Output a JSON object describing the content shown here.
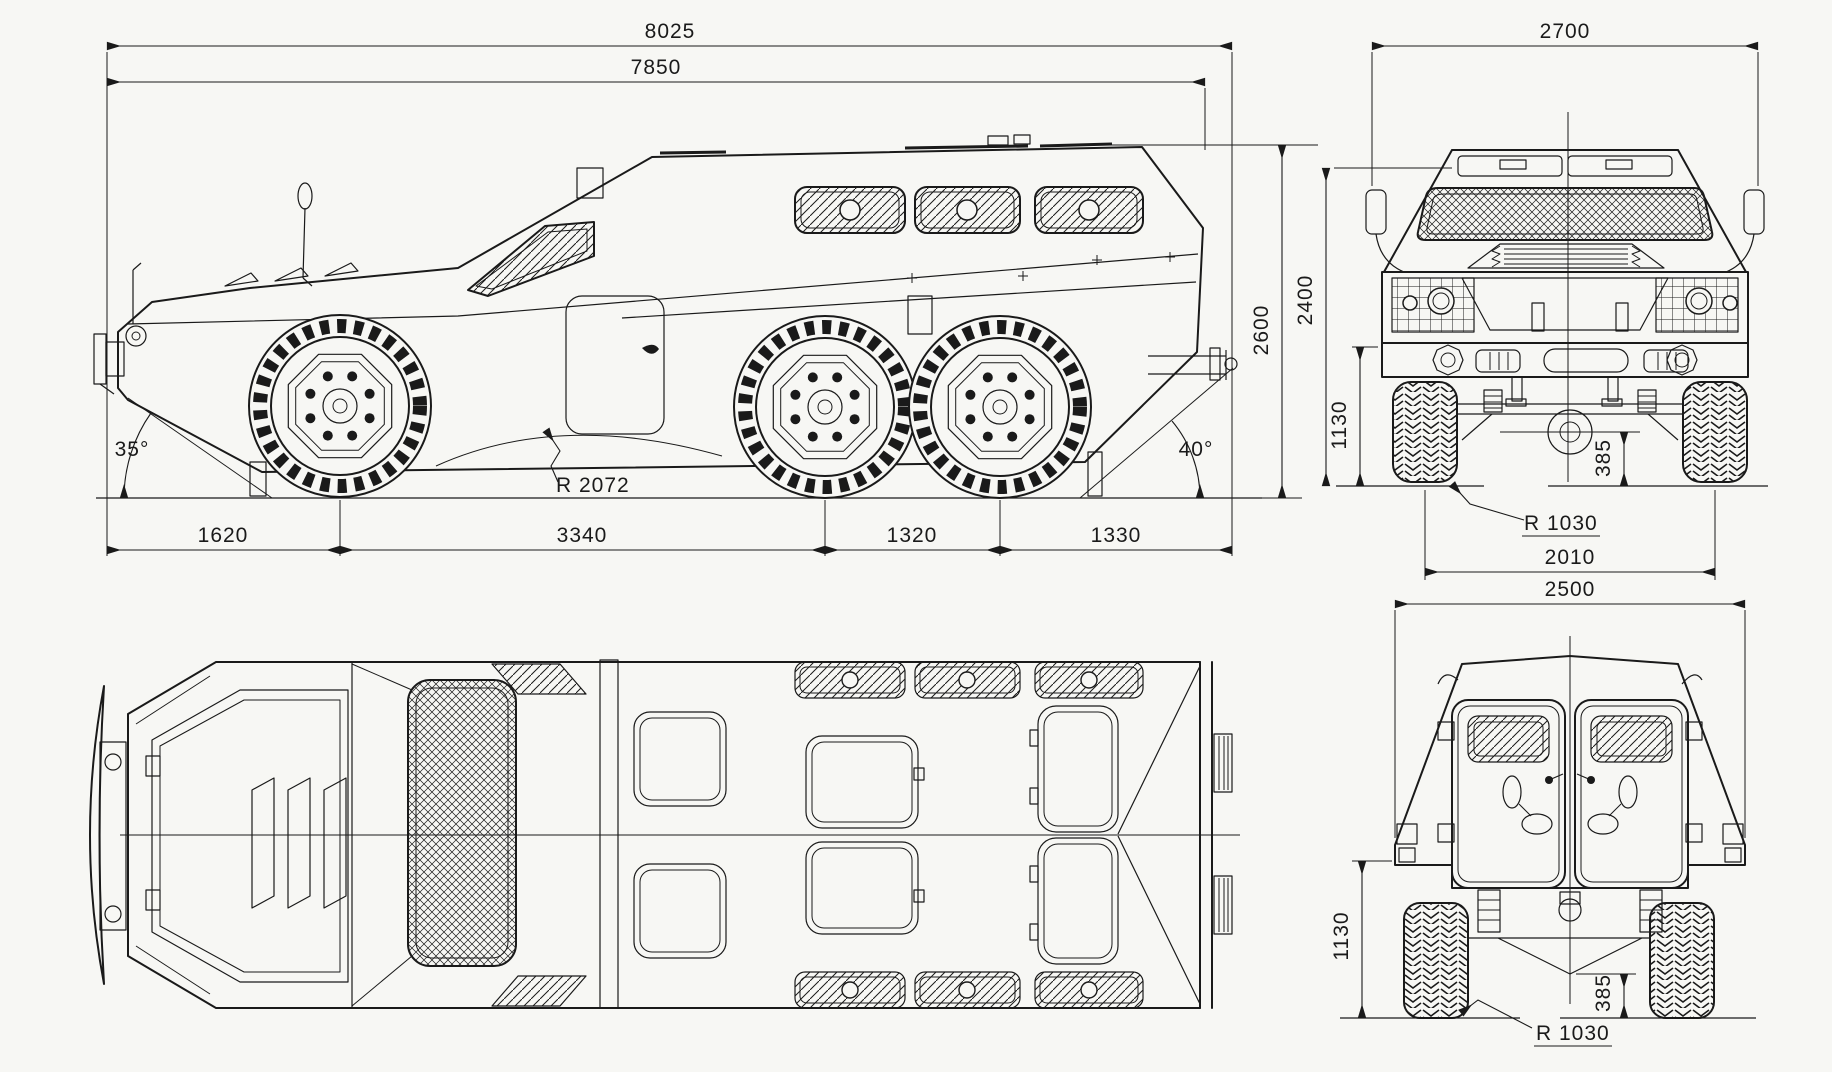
{
  "document": {
    "type": "technical-blueprint",
    "subject": "6x6 armored personnel carrier, four orthographic views",
    "colors": {
      "paper": "#f7f7f4",
      "line": "#1a1a1a"
    }
  },
  "side_view": {
    "overall_length": "8025",
    "hull_length": "7850",
    "front_overhang": "1620",
    "wheelbase_front": "3340",
    "wheelbase_rear": "1320",
    "rear_overhang": "1330",
    "approach_angle": "35°",
    "departure_angle": "40°",
    "breakover_radius": "R 2072"
  },
  "front_view": {
    "overall_width": "2700",
    "overall_height": "2600",
    "hull_height": "2400",
    "bumper_height": "1130",
    "ground_clearance": "385",
    "wheel_radius": "R 1030",
    "track_width": "2010"
  },
  "rear_view": {
    "overall_width": "2500",
    "bumper_height": "1130",
    "ground_clearance": "385",
    "wheel_radius": "R 1030"
  }
}
